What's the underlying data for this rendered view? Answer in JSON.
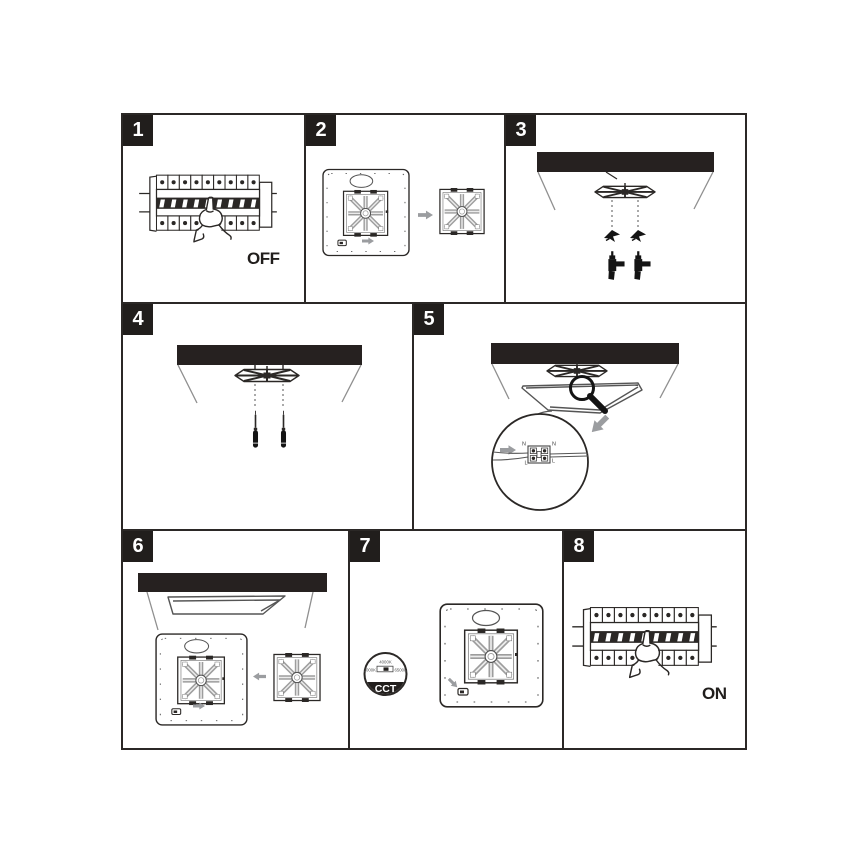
{
  "page": {
    "background": "#ffffff",
    "ink": "#2b2826",
    "gray_arrow": "#9b9da0",
    "wall_line_gray": "#8f8f8f"
  },
  "steps": [
    {
      "num": "1",
      "power_label": "OFF"
    },
    {
      "num": "2"
    },
    {
      "num": "3"
    },
    {
      "num": "4"
    },
    {
      "num": "5",
      "terminals": {
        "top_left": "N",
        "top_right": "N",
        "bottom_left": "L",
        "bottom_right": "L"
      }
    },
    {
      "num": "6"
    },
    {
      "num": "7",
      "cct_dial": {
        "name": "CCT",
        "top_option": "4000K",
        "left_option": "3000K",
        "right_option": "6500K"
      }
    },
    {
      "num": "8",
      "power_label": "ON"
    }
  ]
}
